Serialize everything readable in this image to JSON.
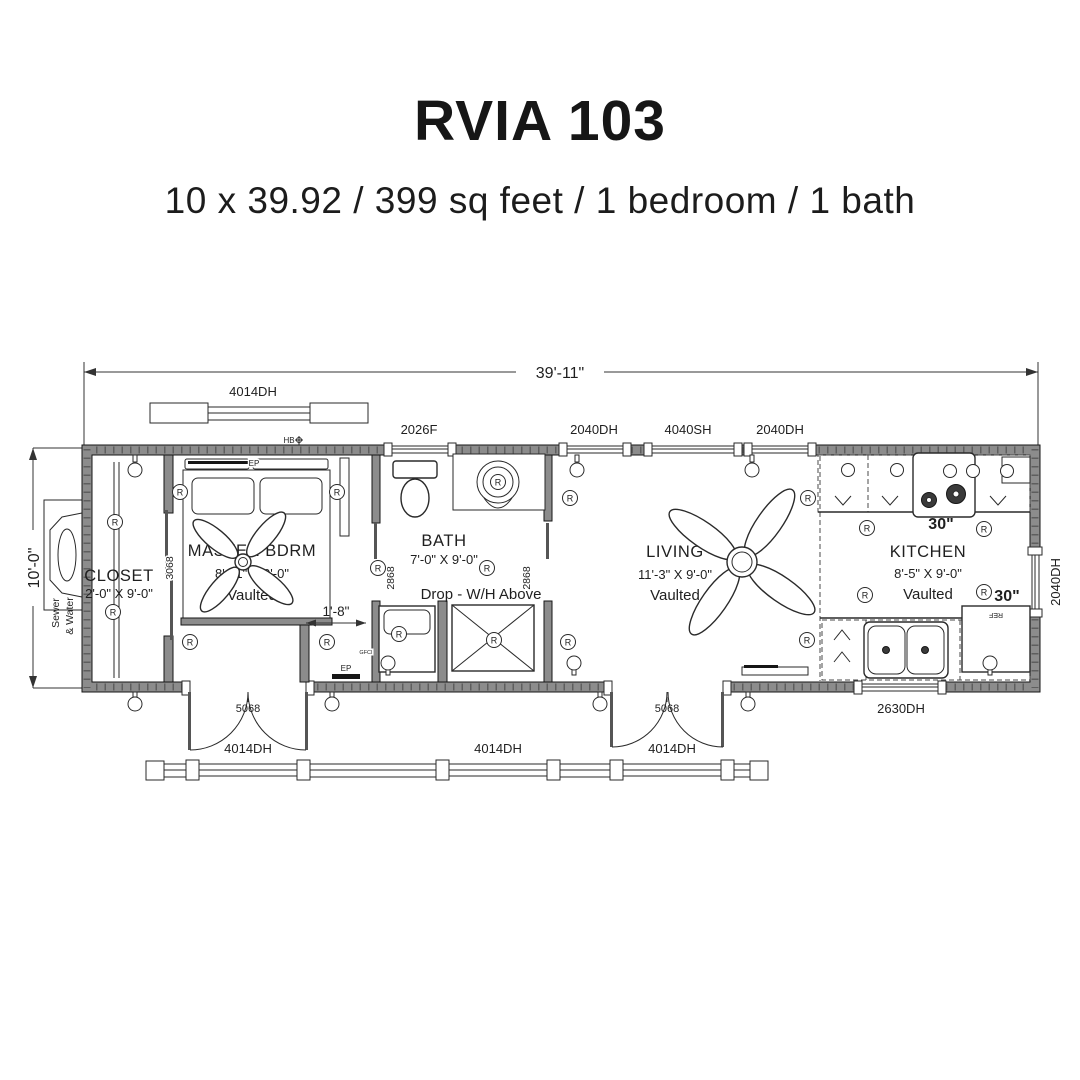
{
  "header": {
    "title": "RVIA 103",
    "subtitle": "10 x 39.92 / 399 sq feet / 1 bedroom / 1 bath"
  },
  "plan": {
    "overall_width": "39'-11\"",
    "overall_depth": "10'-0\"",
    "entry_offset": "1'-8\"",
    "rooms": {
      "closet": {
        "name": "CLOSET",
        "size": "2'-0\" X 9'-0\""
      },
      "master": {
        "name": "MASTER BDRM",
        "size": "8'-11\" X 9'-0\"",
        "note": "Vaulted"
      },
      "bath": {
        "name": "BATH",
        "size": "7'-0\" X 9'-0\"",
        "note": "Drop - W/H Above"
      },
      "living": {
        "name": "LIVING",
        "size": "11'-3\" X 9'-0\"",
        "note": "Vaulted"
      },
      "kitchen": {
        "name": "KITCHEN",
        "size": "8'-5\" X 9'-0\"",
        "note": "Vaulted"
      }
    },
    "openings": {
      "w4014": "4014DH",
      "w2026": "2026F",
      "w2040": "2040DH",
      "w4040": "4040SH",
      "w2630": "2630DH",
      "d5068": "5068",
      "d3068": "3068",
      "d2868": "2868"
    },
    "annotations": {
      "sewer_line1": "Sewer",
      "sewer_line2": "& Water",
      "hose_bib": "HB",
      "electrical_panel": "EP",
      "gfci": "GFCI",
      "fridge": "REF",
      "light": "R",
      "range_width": "30\"",
      "fridge_width": "30\""
    },
    "colors": {
      "ink": "#1f1f1f",
      "wall_gray": "#8c8c8c",
      "background": "#ffffff"
    }
  }
}
